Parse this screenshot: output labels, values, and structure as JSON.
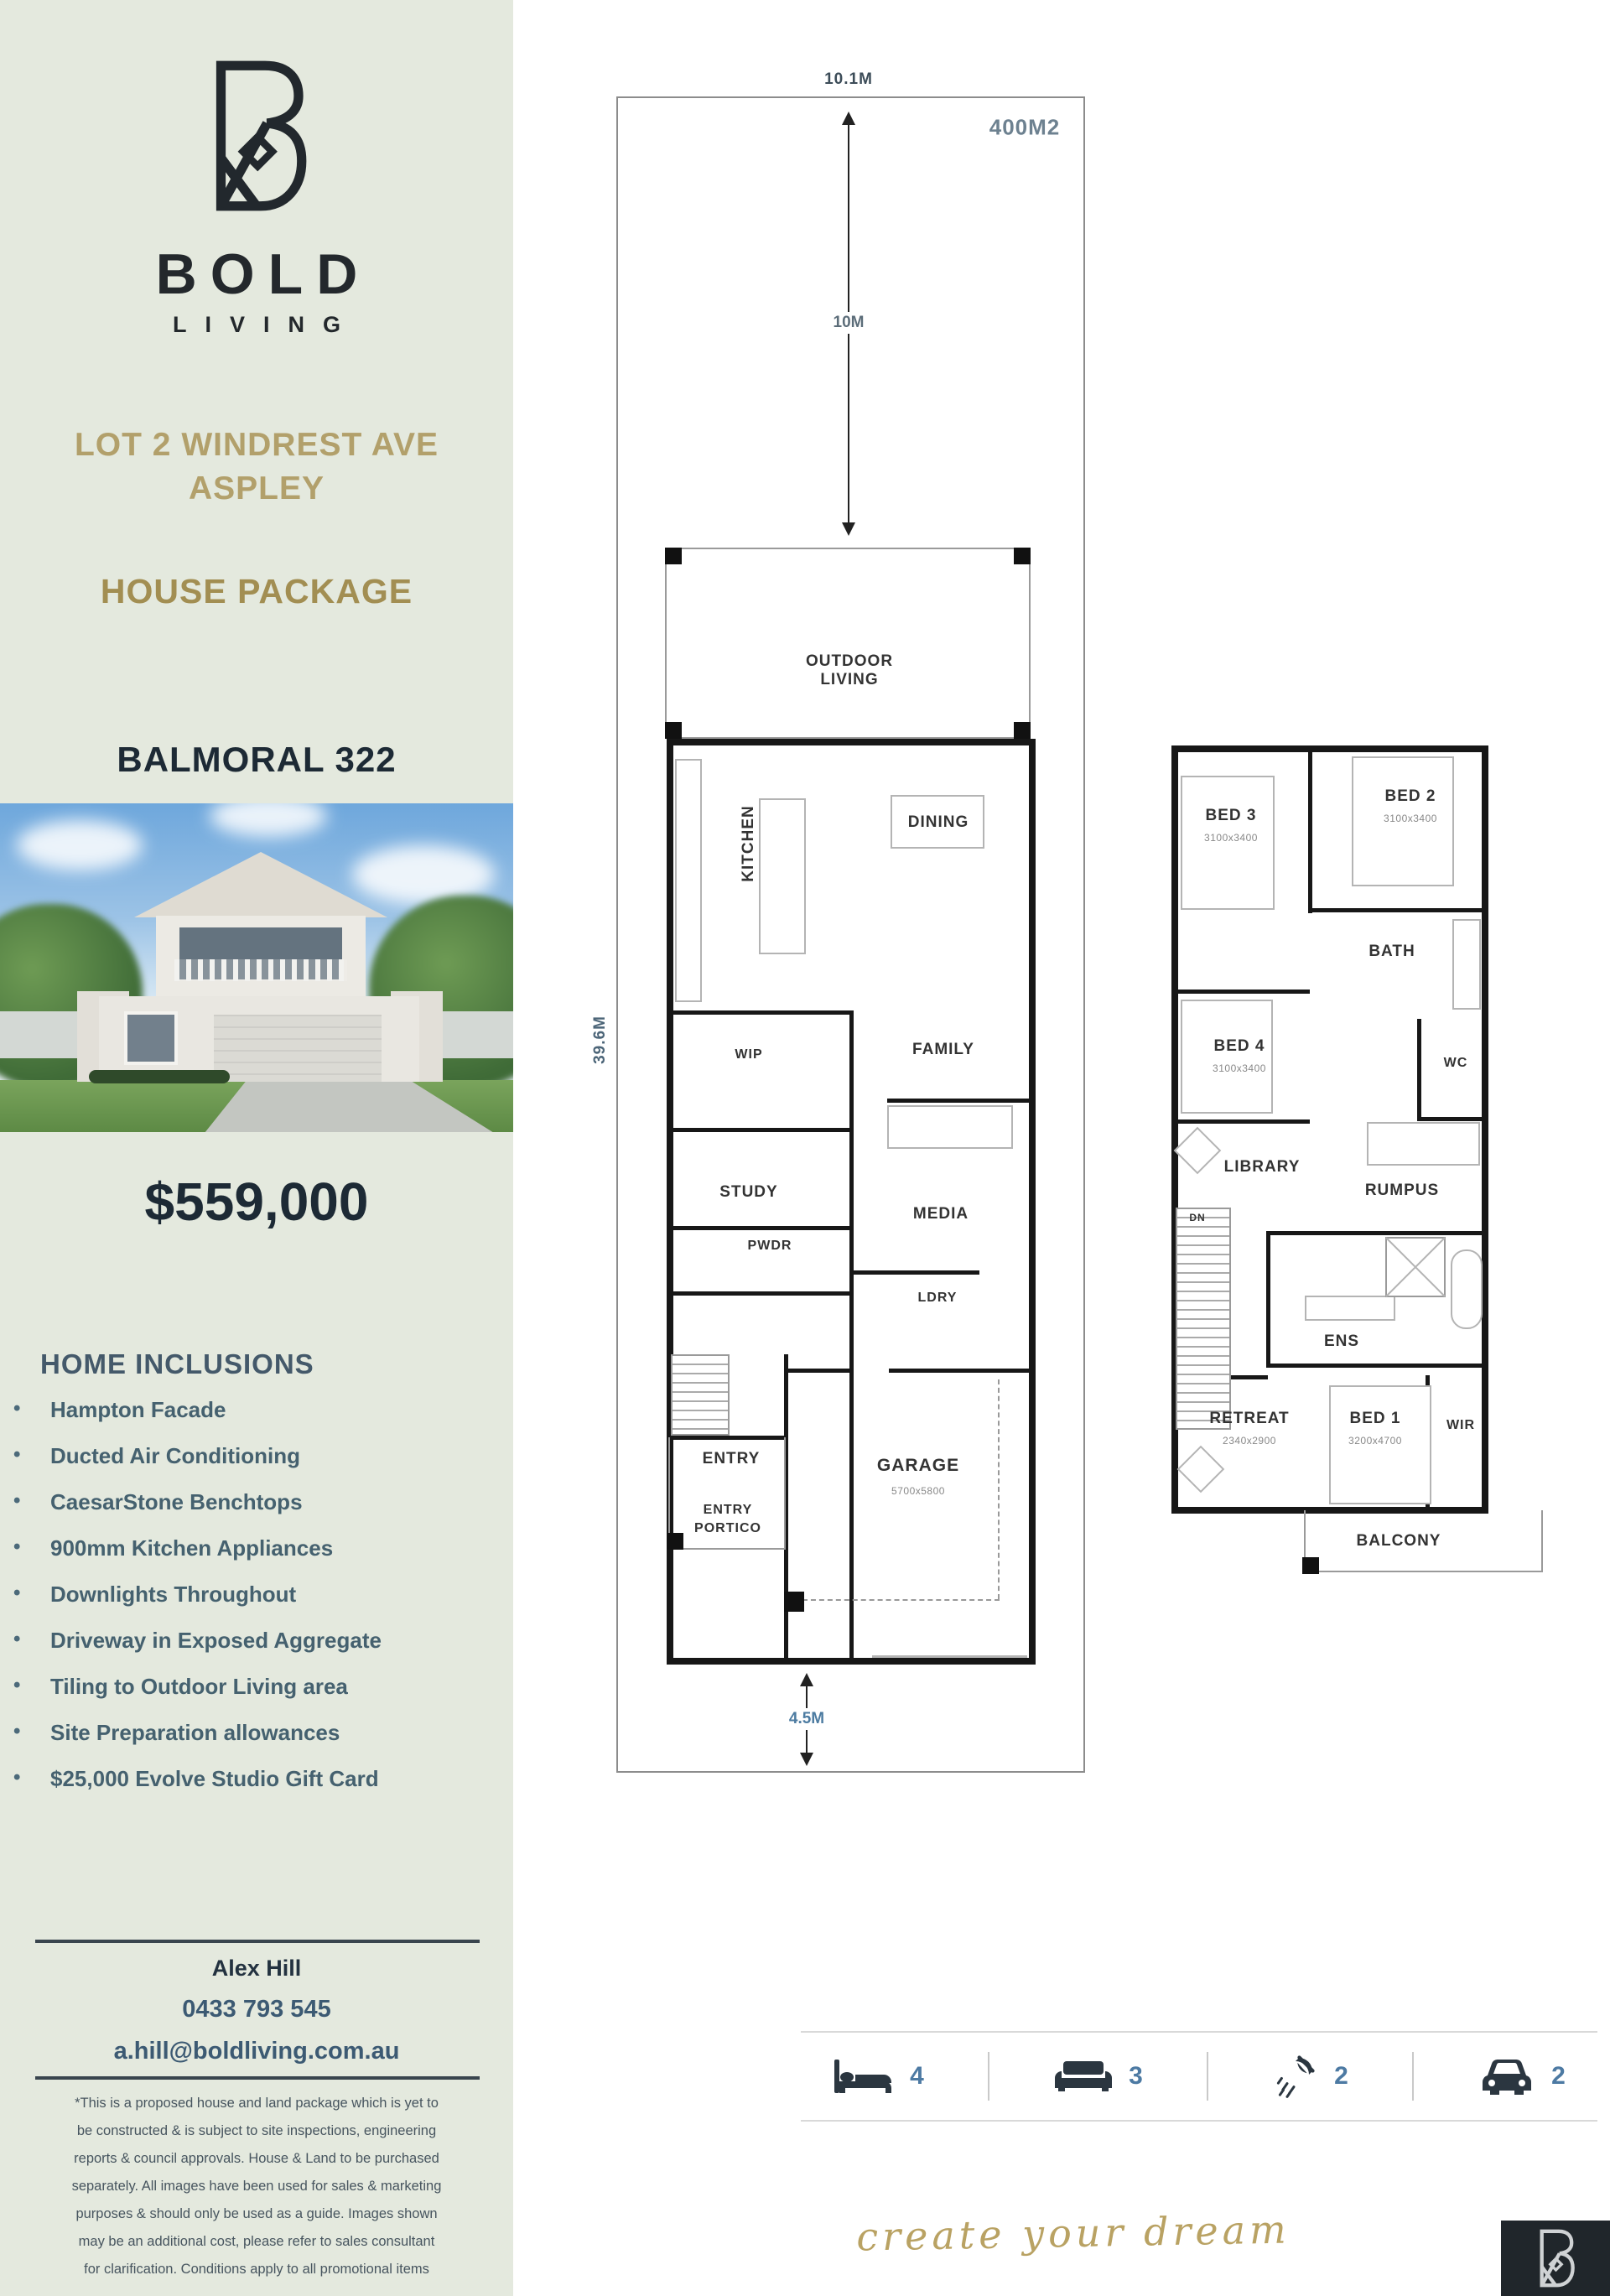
{
  "sidebar": {
    "brand": {
      "word": "BOLD",
      "sub": "LIVING"
    },
    "address1": "LOT 2 WINDREST AVE",
    "address2": "ASPLEY",
    "package_label": "HOUSE PACKAGE",
    "plan_name": "BALMORAL 322",
    "price": "$559,000",
    "inclusions_title": "HOME INCLUSIONS",
    "inclusions": [
      "Hampton Facade",
      "Ducted Air Conditioning",
      "CaesarStone Benchtops",
      "900mm Kitchen Appliances",
      "Downlights Throughout",
      "Driveway in Exposed Aggregate",
      "Tiling to Outdoor Living area",
      "Site Preparation allowances",
      "$25,000 Evolve Studio Gift Card"
    ],
    "contact": {
      "name": "Alex Hill",
      "phone": "0433 793 545",
      "email": "a.hill@boldliving.com.au"
    },
    "disclaimer": [
      "*This is a proposed house and land package which is yet to",
      "be constructed & is subject to site inspections, engineering",
      "reports & council approvals. House & Land to be purchased",
      "separately. All images have been used for sales & marketing",
      "purposes & should only be used as a guide. Images shown",
      "may be an additional cost, please refer to sales consultant",
      "for clarification. Conditions apply to all promotional items"
    ]
  },
  "site": {
    "width_label": "10.1M",
    "area_label": "400M2",
    "front_setback_label": "10M",
    "depth_label": "39.6M",
    "rear_setback_label": "4.5M"
  },
  "gf": {
    "outdoor": "OUTDOOR LIVING",
    "kitchen": "KITCHEN",
    "dining": "DINING",
    "family": "FAMILY",
    "wip": "WIP",
    "study": "STUDY",
    "media": "MEDIA",
    "pwdr": "PWDR",
    "ldry": "LDRY",
    "entry": "ENTRY",
    "garage": "GARAGE",
    "garage_dims": "5700x5800",
    "portico": "ENTRY PORTICO"
  },
  "ff": {
    "bed3": "BED 3",
    "bed3_dims": "3100x3400",
    "bed2": "BED 2",
    "bed2_dims": "3100x3400",
    "bath": "BATH",
    "bed4": "BED 4",
    "bed4_dims": "3100x3400",
    "wc": "WC",
    "library": "LIBRARY",
    "rumpus": "RUMPUS",
    "dn": "DN",
    "ens": "ENS",
    "retreat": "RETREAT",
    "retreat_dims": "2340x2900",
    "bed1": "BED 1",
    "bed1_dims": "3200x4700",
    "wir": "WIR",
    "balcony": "BALCONY"
  },
  "summary": {
    "beds": "4",
    "living": "3",
    "baths": "2",
    "cars": "2"
  },
  "tagline": "create your dream",
  "colors": {
    "sidebar_bg": "#e4e9de",
    "brand_dark": "#23282c",
    "gold": "#b2a06b",
    "gold_dark": "#a28e52",
    "navy": "#1d2a35",
    "slate": "#45616f",
    "steel_blue": "#4d7aa3",
    "wall_black": "#171717",
    "tagline_gold": "#b9a263"
  }
}
